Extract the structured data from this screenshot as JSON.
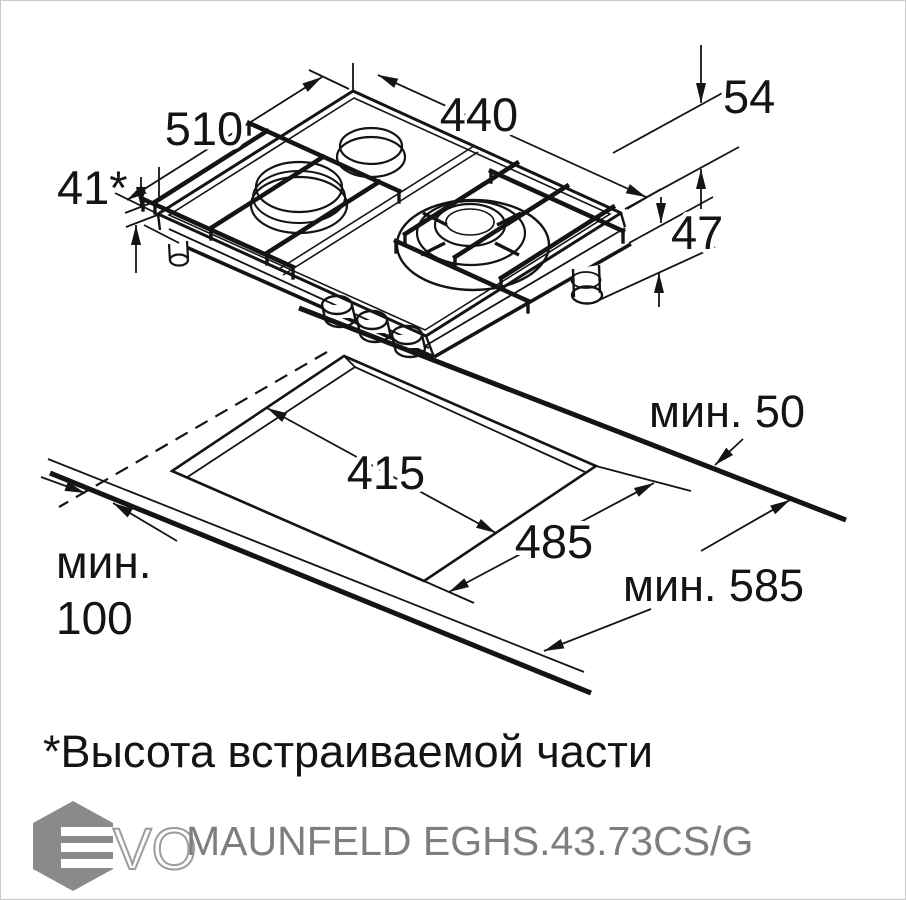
{
  "page": {
    "background": "#ffffff",
    "line_color": "#141414",
    "burner_fill": "#c6c6c6",
    "muted_color": "#7e7e7e"
  },
  "hob_view": {
    "dim_width": "510",
    "dim_depth": "440",
    "dim_total_height": "54",
    "dim_builtin_height": "41*",
    "dim_body_height": "47"
  },
  "cutout_view": {
    "dim_cutout_depth": "415",
    "dim_cutout_width": "485",
    "dim_min_rear": "мин. 50",
    "dim_min_worktop_depth": "мин. 585",
    "dim_min_front_line1": "мин.",
    "dim_min_front_line2": "100"
  },
  "footnote": "*Высота встраиваемой части",
  "footer": {
    "logo_text": "VO",
    "model": "MAUNFELD EGHS.43.73CS/G"
  }
}
